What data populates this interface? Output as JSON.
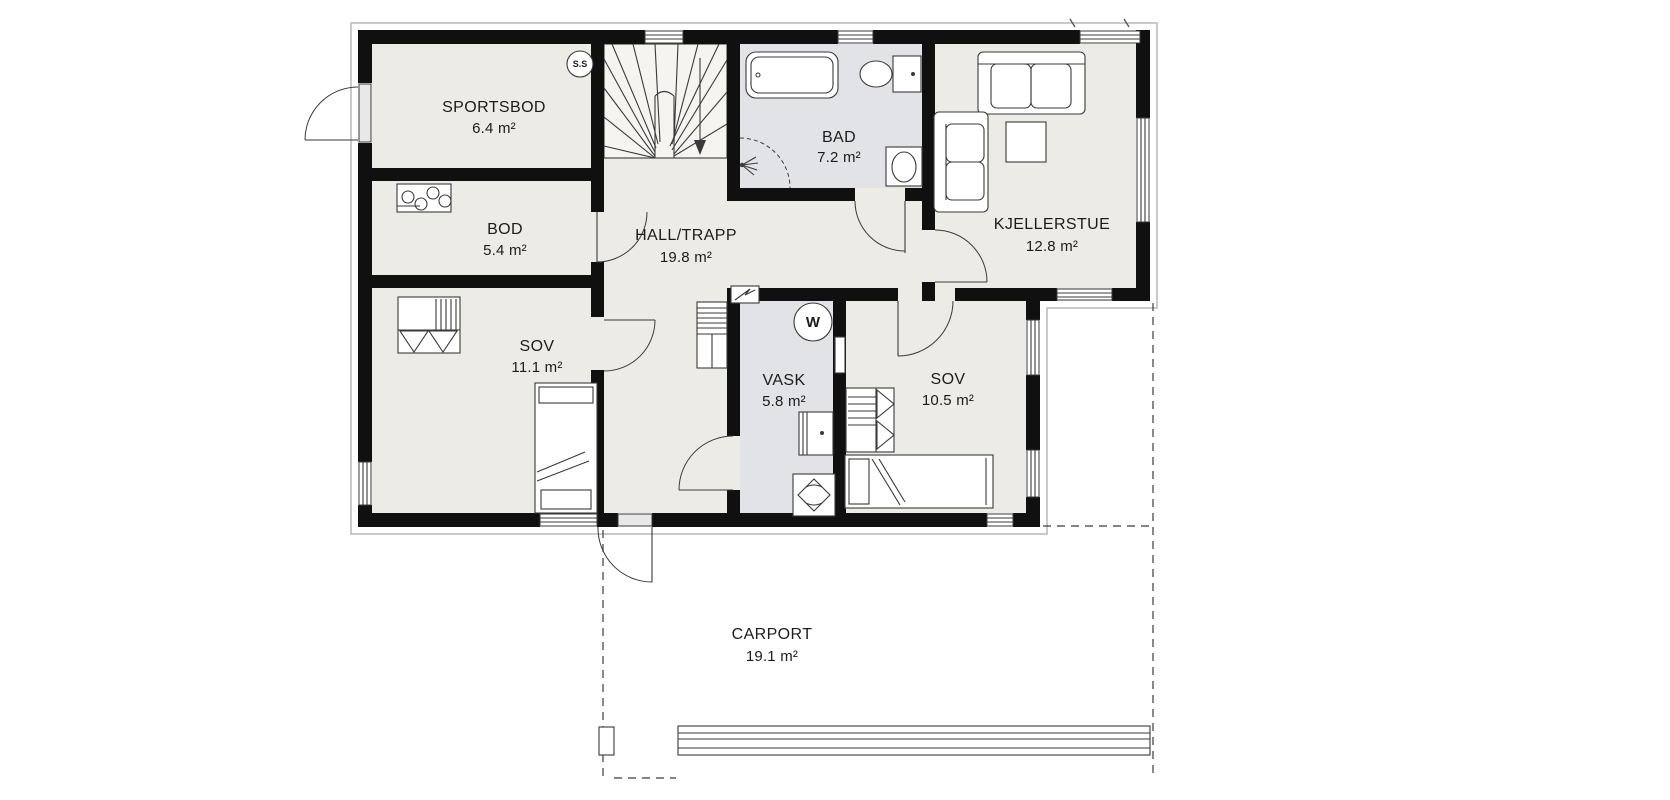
{
  "colors": {
    "paper": "#ffffff",
    "wall": "#101010",
    "ink": "#1c1c1c",
    "line": "#3a3a3a",
    "floor": "#edebe6",
    "wet_floor": "#e2e3e6",
    "stair_floor": "#f5f4f1"
  },
  "plan": {
    "type": "floor-plan",
    "rooms": [
      {
        "id": "sportsbod",
        "name": "SPORTSBOD",
        "area": "6.4 m²"
      },
      {
        "id": "bod",
        "name": "BOD",
        "area": "5.4 m²"
      },
      {
        "id": "hall-trapp",
        "name": "HALL/TRAPP",
        "area": "19.8 m²"
      },
      {
        "id": "bad",
        "name": "BAD",
        "area": "7.2 m²"
      },
      {
        "id": "kjellerstue",
        "name": "KJELLERSTUE",
        "area": "12.8 m²"
      },
      {
        "id": "sov-1",
        "name": "SOV",
        "area": "11.1 m²"
      },
      {
        "id": "vask",
        "name": "VASK",
        "area": "5.8 m²"
      },
      {
        "id": "sov-2",
        "name": "SOV",
        "area": "10.5 m²"
      },
      {
        "id": "carport",
        "name": "CARPORT",
        "area": "19.1 m²"
      }
    ],
    "symbols": {
      "fuse_circle_label": "S.S",
      "water_heater_label": "W"
    },
    "fixtures": [
      "staircase-winder",
      "bathtub",
      "toilet",
      "washbasin",
      "shower-corner",
      "sofa",
      "loveseat",
      "side-table",
      "wardrobe",
      "bed-single",
      "washing-machine",
      "floor-drain",
      "water-heater",
      "fuse-box",
      "washer-hookup-circles",
      "hall-cabinet",
      "carport-beam",
      "carport-post"
    ]
  }
}
